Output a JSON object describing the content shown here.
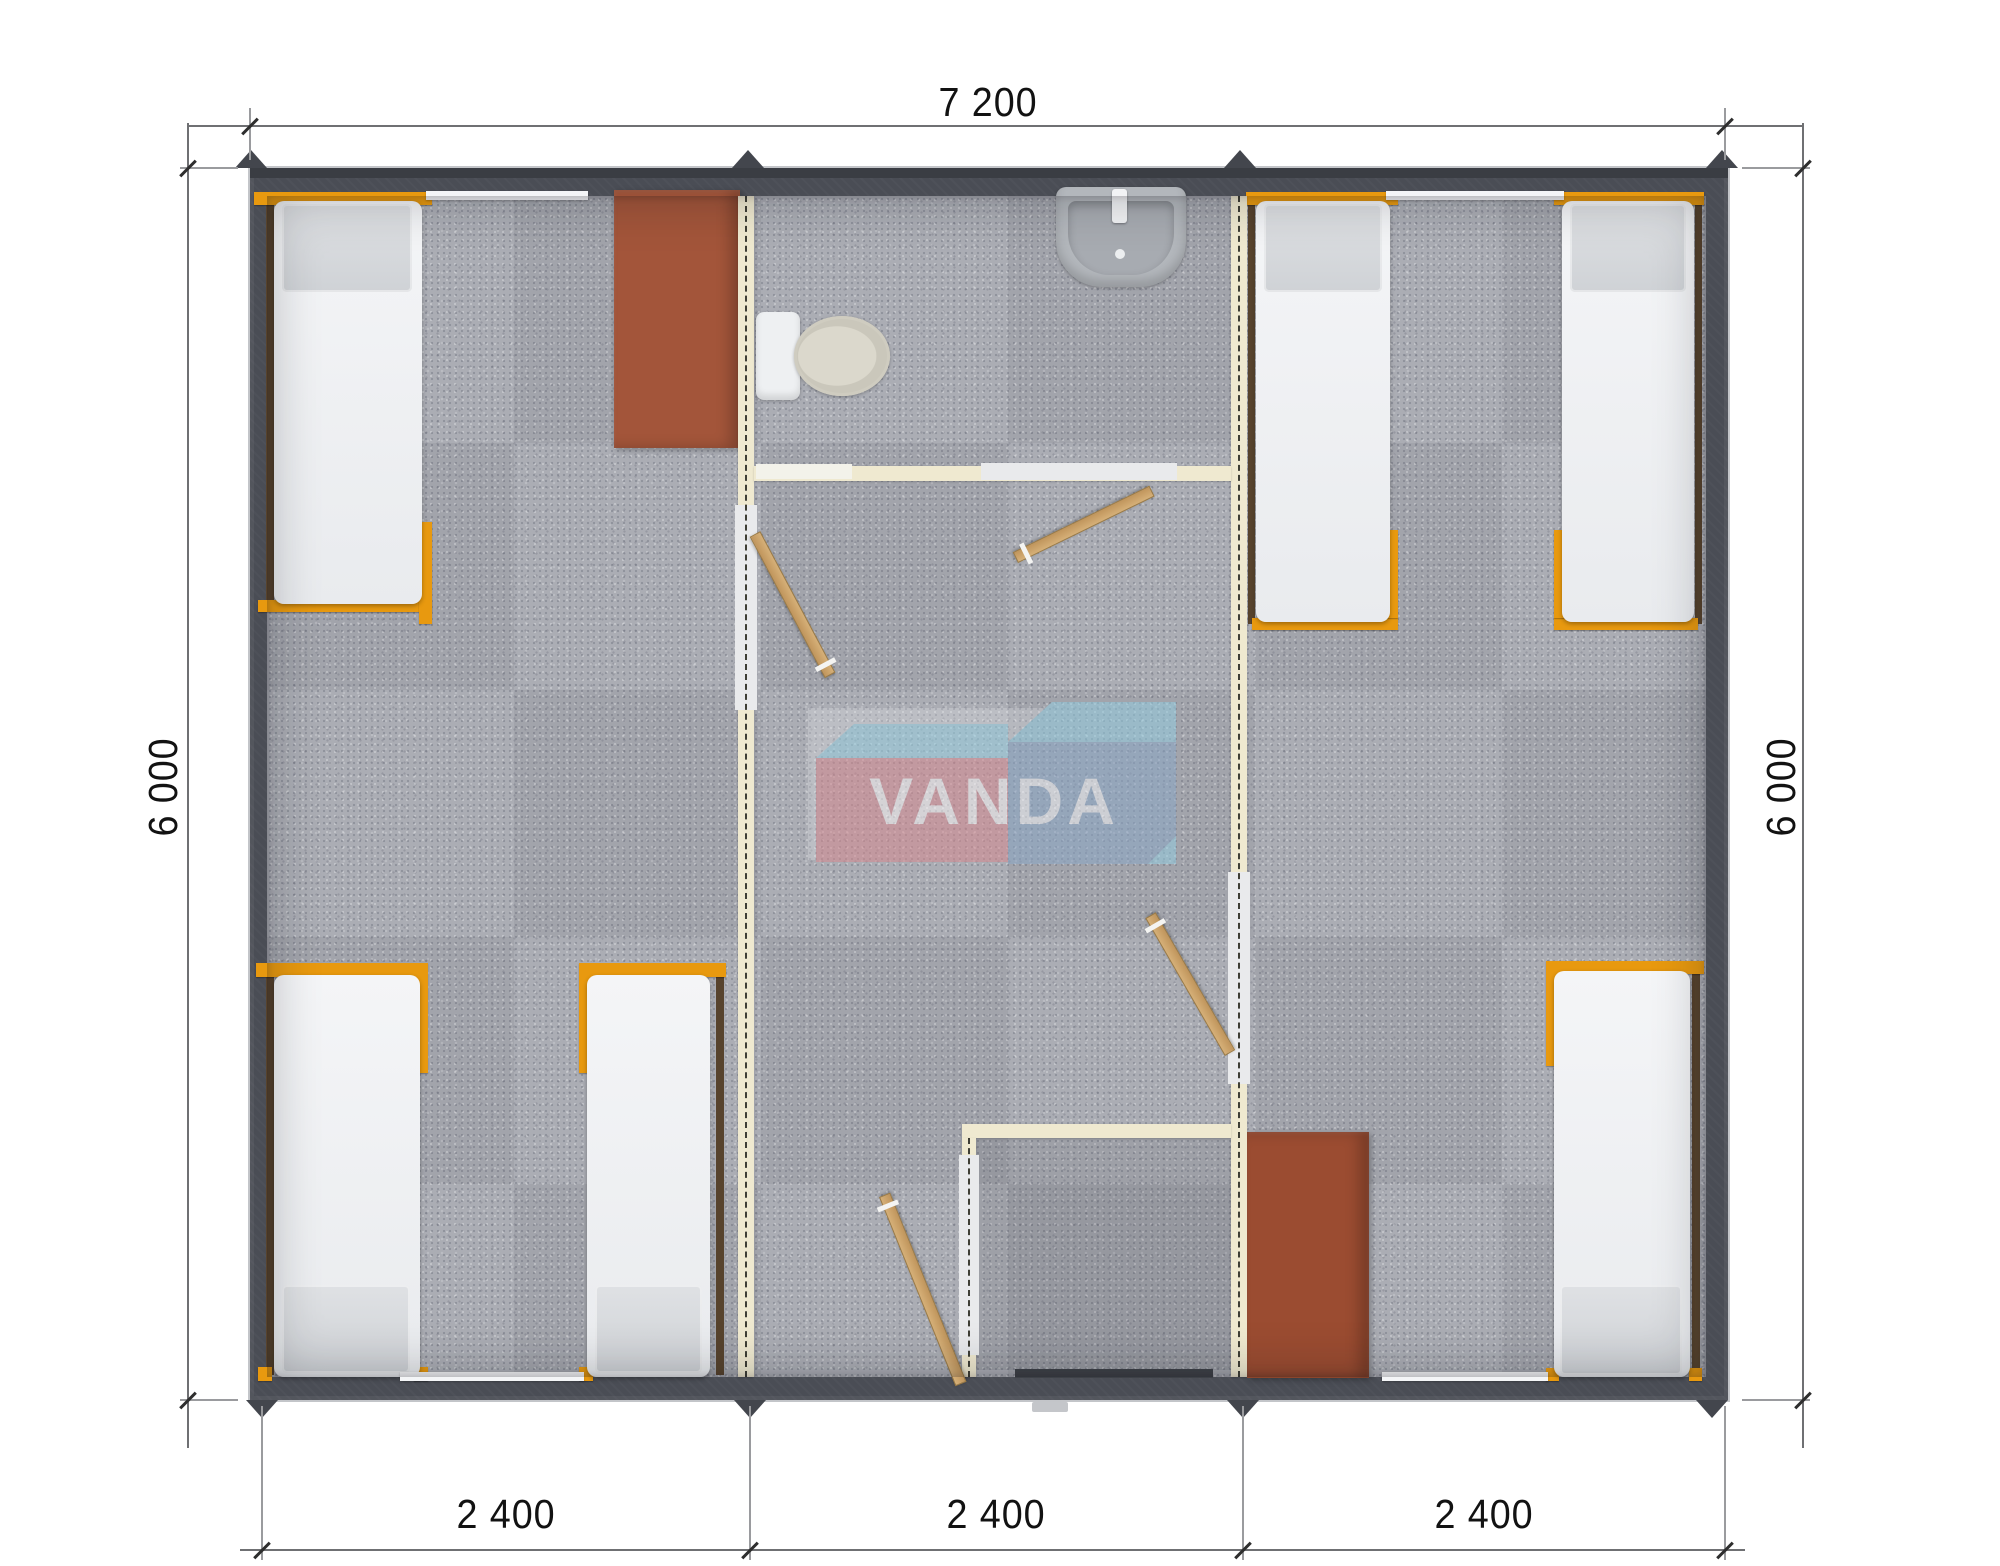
{
  "watermark": {
    "text": "VANDA"
  },
  "dimensions": {
    "top": "7 200",
    "left": "6 000",
    "right": "6 000",
    "bottom": [
      "2 400",
      "2 400",
      "2 400"
    ]
  },
  "colors": {
    "exterior_wall": "#4a4d55",
    "partition": "#efe9d0",
    "floor_carpet": "#a8aab2",
    "bed_frame_orange": "#e8990f",
    "mattress": "#f2f3f5",
    "pillow": "#d8dade",
    "wardrobe_brown": "#a3553a",
    "door_wood": "#c9a36c",
    "logo_red": "#d8878e",
    "logo_blue": "#8ba8c8",
    "logo_cyan": "#95d0e3"
  }
}
